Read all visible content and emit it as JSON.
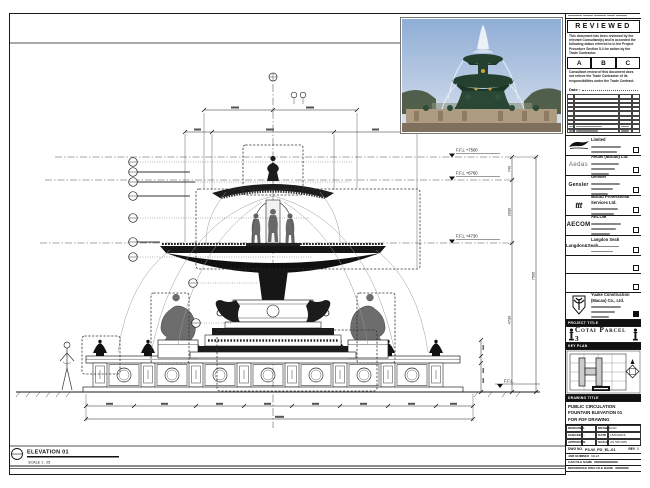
{
  "stamp": {
    "title": "REVIEWED",
    "para1": "This document has been reviewed by the relevant Consultant(s) and is accorded the following status referred to in the Project Procedure Section 5.4 for action by the Trade Contractor.",
    "options": {
      "a": "A",
      "b": "B",
      "c": "C"
    },
    "para2": "Consultant review of this document does not relieve the Trade Contractor of its responsibilities under the Trade Contract.",
    "date_label": "Date :"
  },
  "consultants": [
    {
      "logo": "VOL",
      "name": "Venetian Orient Limited"
    },
    {
      "logo": "Aedas",
      "name": "Aedas (Macau) Ltd."
    },
    {
      "logo": "Gensler",
      "name": "Gensler"
    },
    {
      "logo": "ttt",
      "name": "Macau Professional Services Ltd."
    },
    {
      "logo": "AECOM",
      "name": "AECOM"
    },
    {
      "logo": "Langdon&Seah",
      "name": "Langdon Seah"
    }
  ],
  "contractor": {
    "name": "Yuake Construction (Macau) Co., Ltd."
  },
  "project": {
    "header": "PROJECT TITLE",
    "name": "Cotai Parcel 3"
  },
  "key_plan": {
    "header": "KEY PLAN"
  },
  "drawing": {
    "header": "DRAWING TITLE",
    "line1": "PUBLIC CIRCULATION",
    "line2": "FOUNTAIN ELEVATION 01",
    "line3": "FOR FDF DRAWING",
    "designed_label": "DESIGNED",
    "designed": "-",
    "drawn_label": "DRAWN",
    "drawn": "CAD",
    "checked_label": "CHECKED",
    "checked": "-",
    "date_label": "DATE",
    "date": "15/04/2016",
    "approved_label": "APPROVED",
    "approved": "-",
    "scale_label": "SCALE",
    "scale": "AS SHOWN",
    "dwg_no_label": "DWG NO.",
    "dwg_no": "P3-W_FD_EL-01",
    "rev_label": "REV",
    "rev": "0",
    "job_label": "JOB NUMBER",
    "job": "31123",
    "cad_label": "CAD FILE NAME",
    "ref_label": "REFERENCE DWG FILE NAME"
  },
  "elevation": {
    "label": "ELEVATION 01",
    "scale_note": "SCALE  1 : 25"
  },
  "levels": {
    "l7500": "F.F.L +7500",
    "l6760": "F.F.L +6760",
    "l4730": "F.F.L +4730",
    "l0": "F.F.L."
  },
  "dims": {
    "d740": "740",
    "d2030": "2030",
    "d4730": "4730",
    "d7500": "7500"
  }
}
